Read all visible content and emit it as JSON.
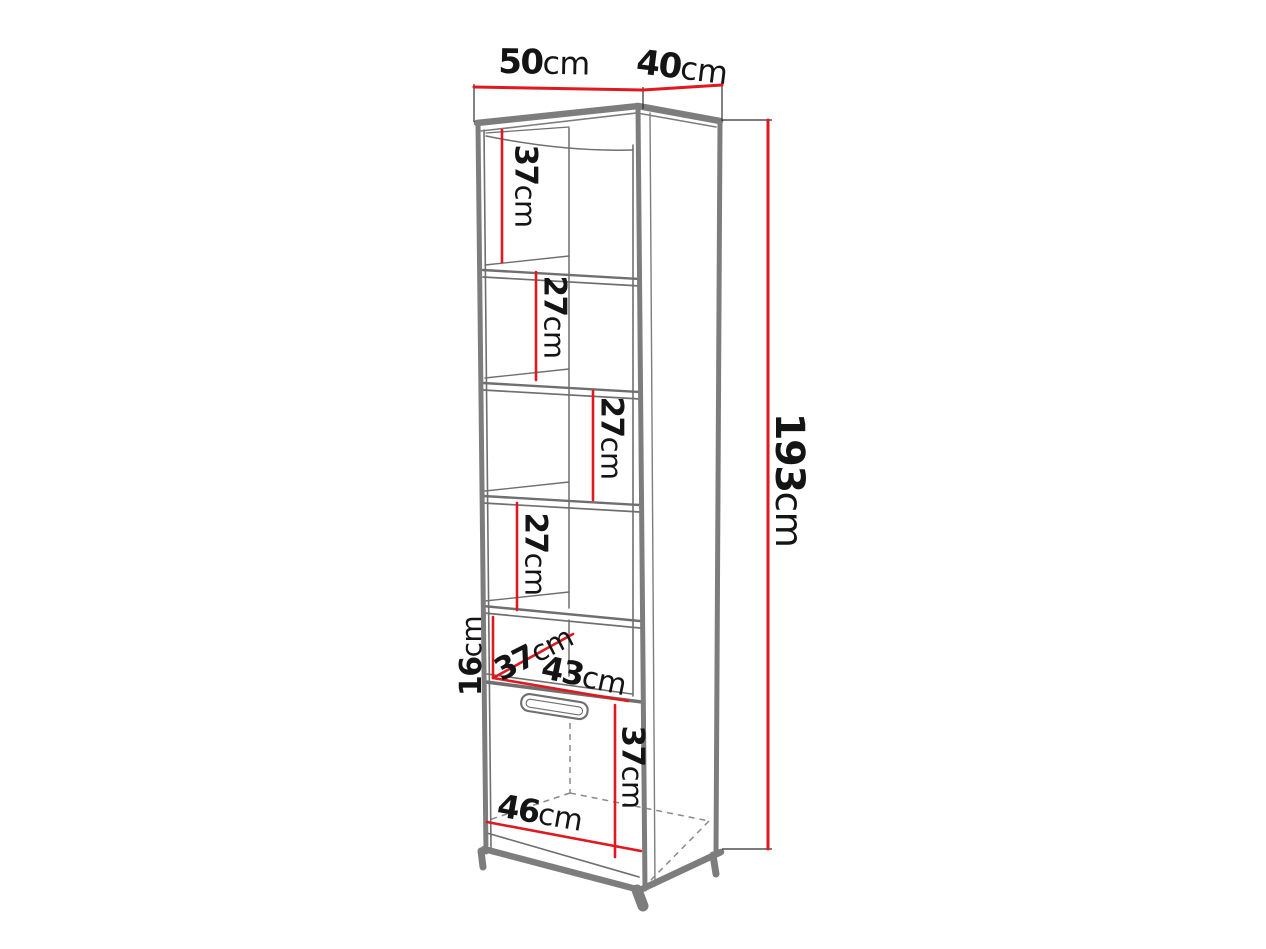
{
  "diagram": {
    "kind": "furniture-dimension-diagram",
    "dimensions": {
      "top_width": {
        "value": "50",
        "unit": "cm"
      },
      "top_depth": {
        "value": "40",
        "unit": "cm"
      },
      "total_height": {
        "value": "193",
        "unit": "cm"
      },
      "compartment_1": {
        "value": "37",
        "unit": "cm"
      },
      "compartment_2": {
        "value": "27",
        "unit": "cm"
      },
      "compartment_3": {
        "value": "27",
        "unit": "cm"
      },
      "compartment_4": {
        "value": "27",
        "unit": "cm"
      },
      "niche_height": {
        "value": "16",
        "unit": "cm"
      },
      "niche_depth": {
        "value": "37",
        "unit": "cm"
      },
      "niche_width": {
        "value": "43",
        "unit": "cm"
      },
      "door_height": {
        "value": "37",
        "unit": "cm"
      },
      "bottom_width": {
        "value": "46",
        "unit": "cm"
      }
    },
    "colors": {
      "dimension_line": "#e0181f",
      "outline": "#7d7d7d",
      "interior_line": "#6f6f6f",
      "hidden_edge": "#8a8a8a",
      "extension_line": "#2f2f2f",
      "text": "#141414",
      "background": "#ffffff"
    }
  }
}
